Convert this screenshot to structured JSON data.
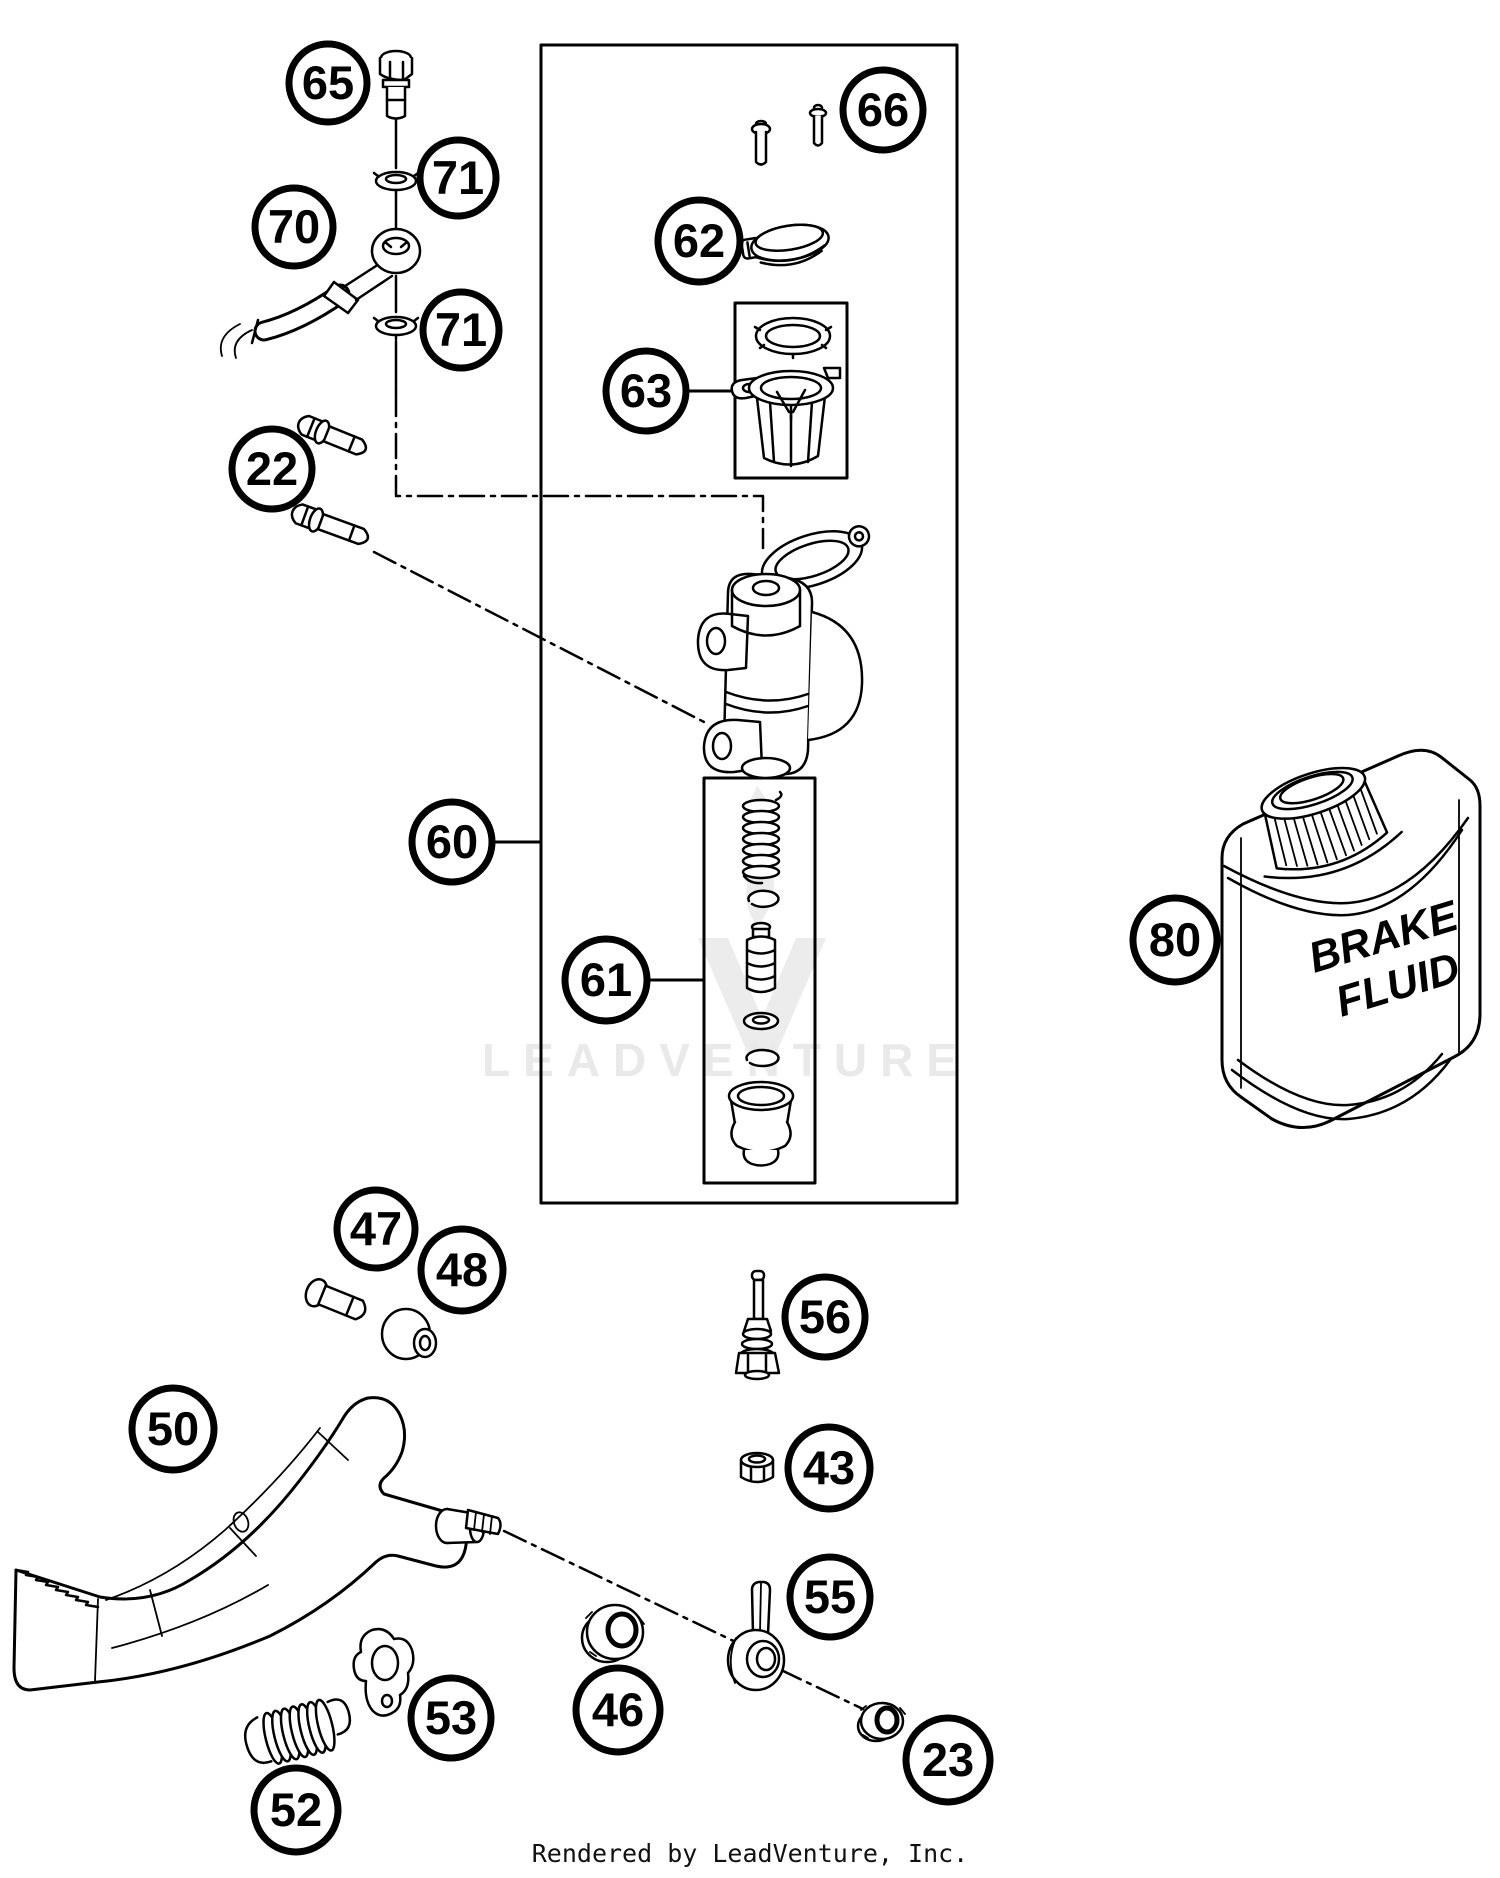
{
  "colors": {
    "line": "#000000",
    "background": "#ffffff",
    "watermark": "#e9e9e9"
  },
  "callouts": [
    {
      "label": "65"
    },
    {
      "label": "71"
    },
    {
      "label": "70"
    },
    {
      "label": "71"
    },
    {
      "label": "22"
    },
    {
      "label": "66"
    },
    {
      "label": "62"
    },
    {
      "label": "63"
    },
    {
      "label": "60"
    },
    {
      "label": "61"
    },
    {
      "label": "80"
    },
    {
      "label": "47"
    },
    {
      "label": "48"
    },
    {
      "label": "50"
    },
    {
      "label": "56"
    },
    {
      "label": "43"
    },
    {
      "label": "55"
    },
    {
      "label": "46"
    },
    {
      "label": "53"
    },
    {
      "label": "52"
    },
    {
      "label": "23"
    }
  ],
  "bottle": {
    "line1": "BRAKE",
    "line2": "FLUID"
  },
  "watermark": {
    "text": "LEADVENTURE"
  },
  "footer": {
    "text": "Rendered by LeadVenture, Inc."
  }
}
